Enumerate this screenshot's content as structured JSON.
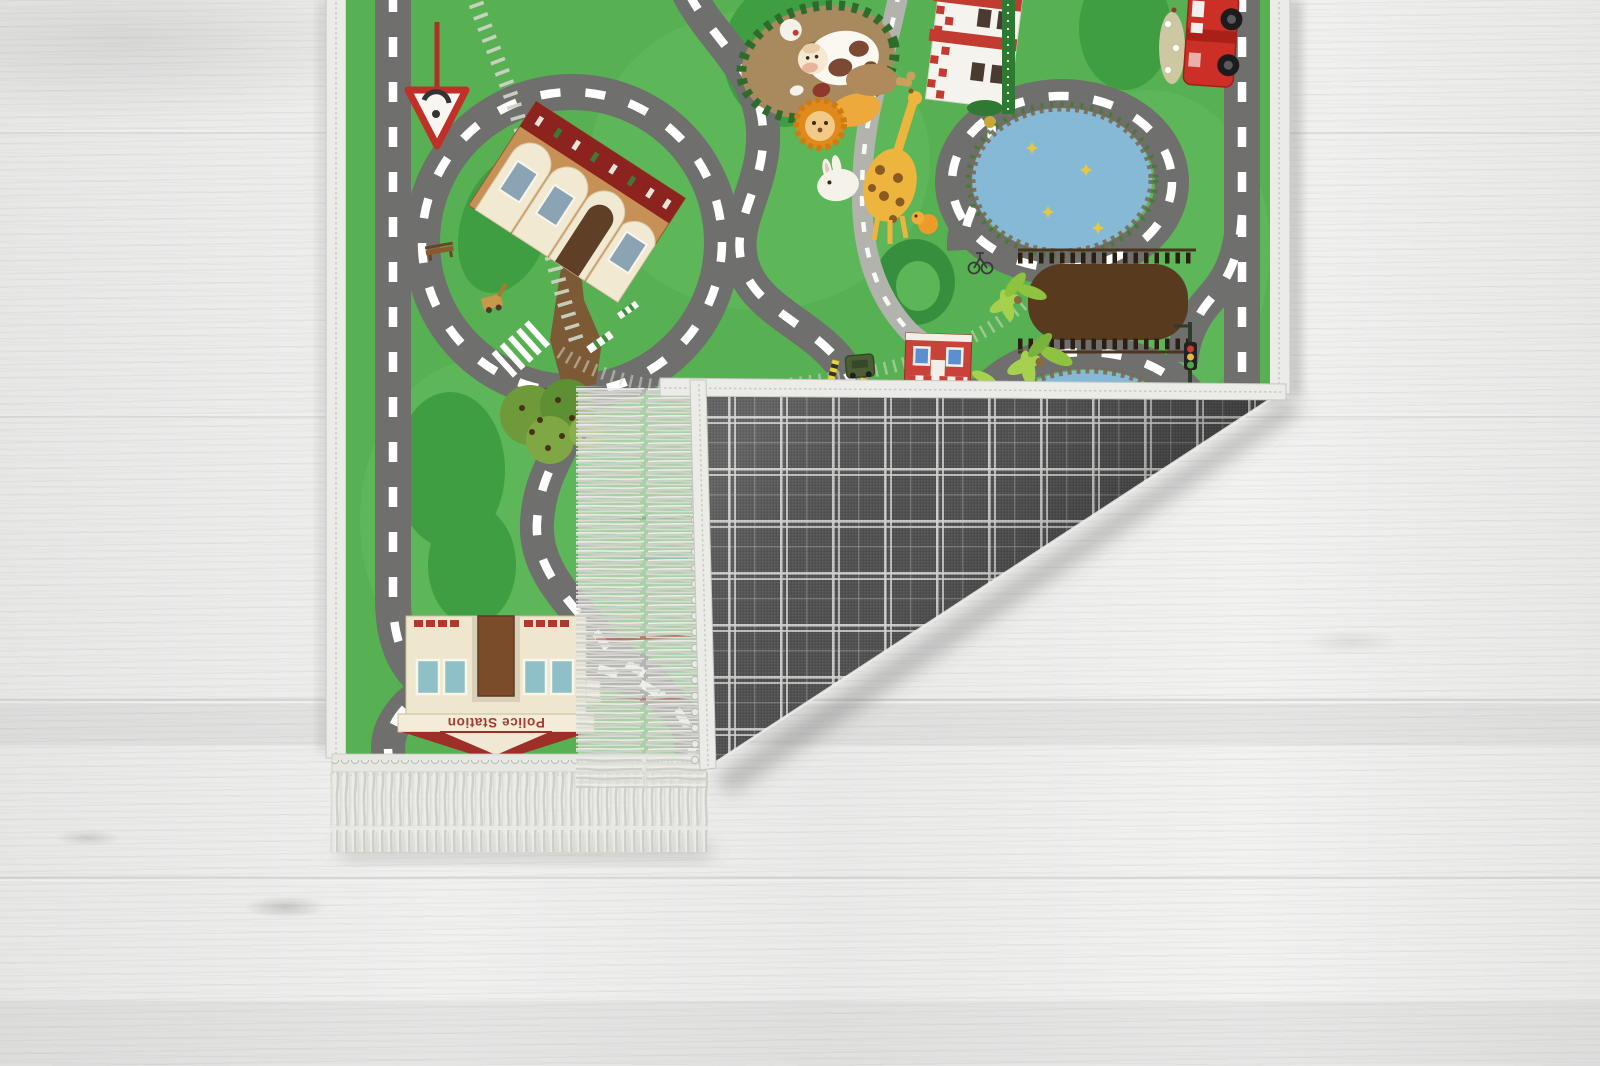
{
  "meta": {
    "domain": "natural-image",
    "subject": "Children's city-road play rug photographed on whitewashed wood floor; bottom-right corner folded over showing gray windowpane-plaid backing and fringe tassels"
  },
  "palette": {
    "floor_base": "#ebebea",
    "floor_grain": "#c8c8c6",
    "rug_green": "#57b153",
    "rug_green_light": "#63bb5e",
    "rug_green_dark": "#3f9e42",
    "road_gray": "#6f6f6d",
    "road_light": "#b3b3ad",
    "road_dash": "#ffffff",
    "track": "#ccd3c4",
    "binding_white": "#ebebe8",
    "fringe": "#d9d9d4",
    "plaid_base": "#515151",
    "plaid_line": "#d9d9d6",
    "pond_blue": "#86b9d6",
    "bridge_brown": "#583a1f",
    "station_tan": "#c79057",
    "roof_red": "#8c231f",
    "fire_red": "#c8352b",
    "cream": "#f2e9d2",
    "police_cream": "#efe7cd",
    "sign_text_red": "#a83a30"
  },
  "rug": {
    "police_station_sign": "Police Station",
    "front_elements": [
      "left-road",
      "roundabout-loop",
      "train-station",
      "railway-track",
      "yield-sign",
      "crosswalk",
      "apple-tree",
      "park-bench",
      "digger",
      "monkey-island",
      "cow",
      "lion",
      "giraffe",
      "rabbit",
      "duckling",
      "fire-station",
      "hedge",
      "fire-truck",
      "upper-pond",
      "lower-pond",
      "wooden-bridge",
      "palm-trees",
      "corner-shop",
      "traffic-light",
      "bicycle",
      "army-jeep",
      "crossing-posts",
      "police-roundabout",
      "police-station"
    ],
    "back_pattern": "gray windowpane plaid",
    "fold": "bottom-right corner folded up-left, fringe on folded edge"
  }
}
